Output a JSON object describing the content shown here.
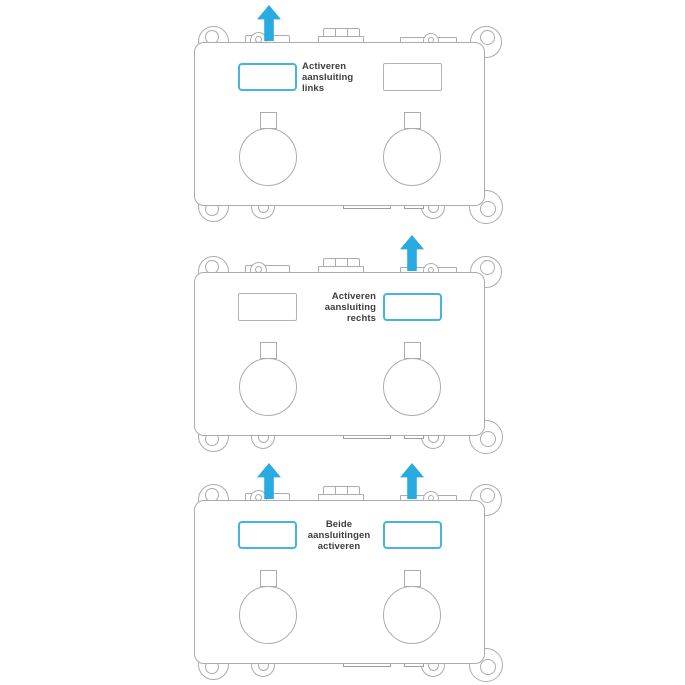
{
  "colors": {
    "accent": "#29ABE2",
    "highlight_border": "#45B4DF",
    "outline": "#ACACAC",
    "text": "#3E3E3E"
  },
  "devices": [
    {
      "id": "activate-left-connection",
      "label_text": "Activeren aansluiting links",
      "label_lines": [
        "Activeren",
        "aansluiting",
        "links"
      ],
      "label_align": "left",
      "arrows": [
        "left"
      ],
      "slots": {
        "left": "highlighted",
        "right": "normal"
      }
    },
    {
      "id": "activate-right-connection",
      "label_text": "Activeren aansluiting rechts",
      "label_lines": [
        "Activeren",
        "aansluiting",
        "rechts"
      ],
      "label_align": "right",
      "arrows": [
        "right"
      ],
      "slots": {
        "left": "normal",
        "right": "highlighted"
      }
    },
    {
      "id": "activate-both-connections",
      "label_text": "Beide aansluitingen activeren",
      "label_lines": [
        "Beide",
        "aansluitingen",
        "activeren"
      ],
      "label_align": "center",
      "arrows": [
        "left",
        "right"
      ],
      "slots": {
        "left": "highlighted",
        "right": "highlighted"
      }
    }
  ]
}
